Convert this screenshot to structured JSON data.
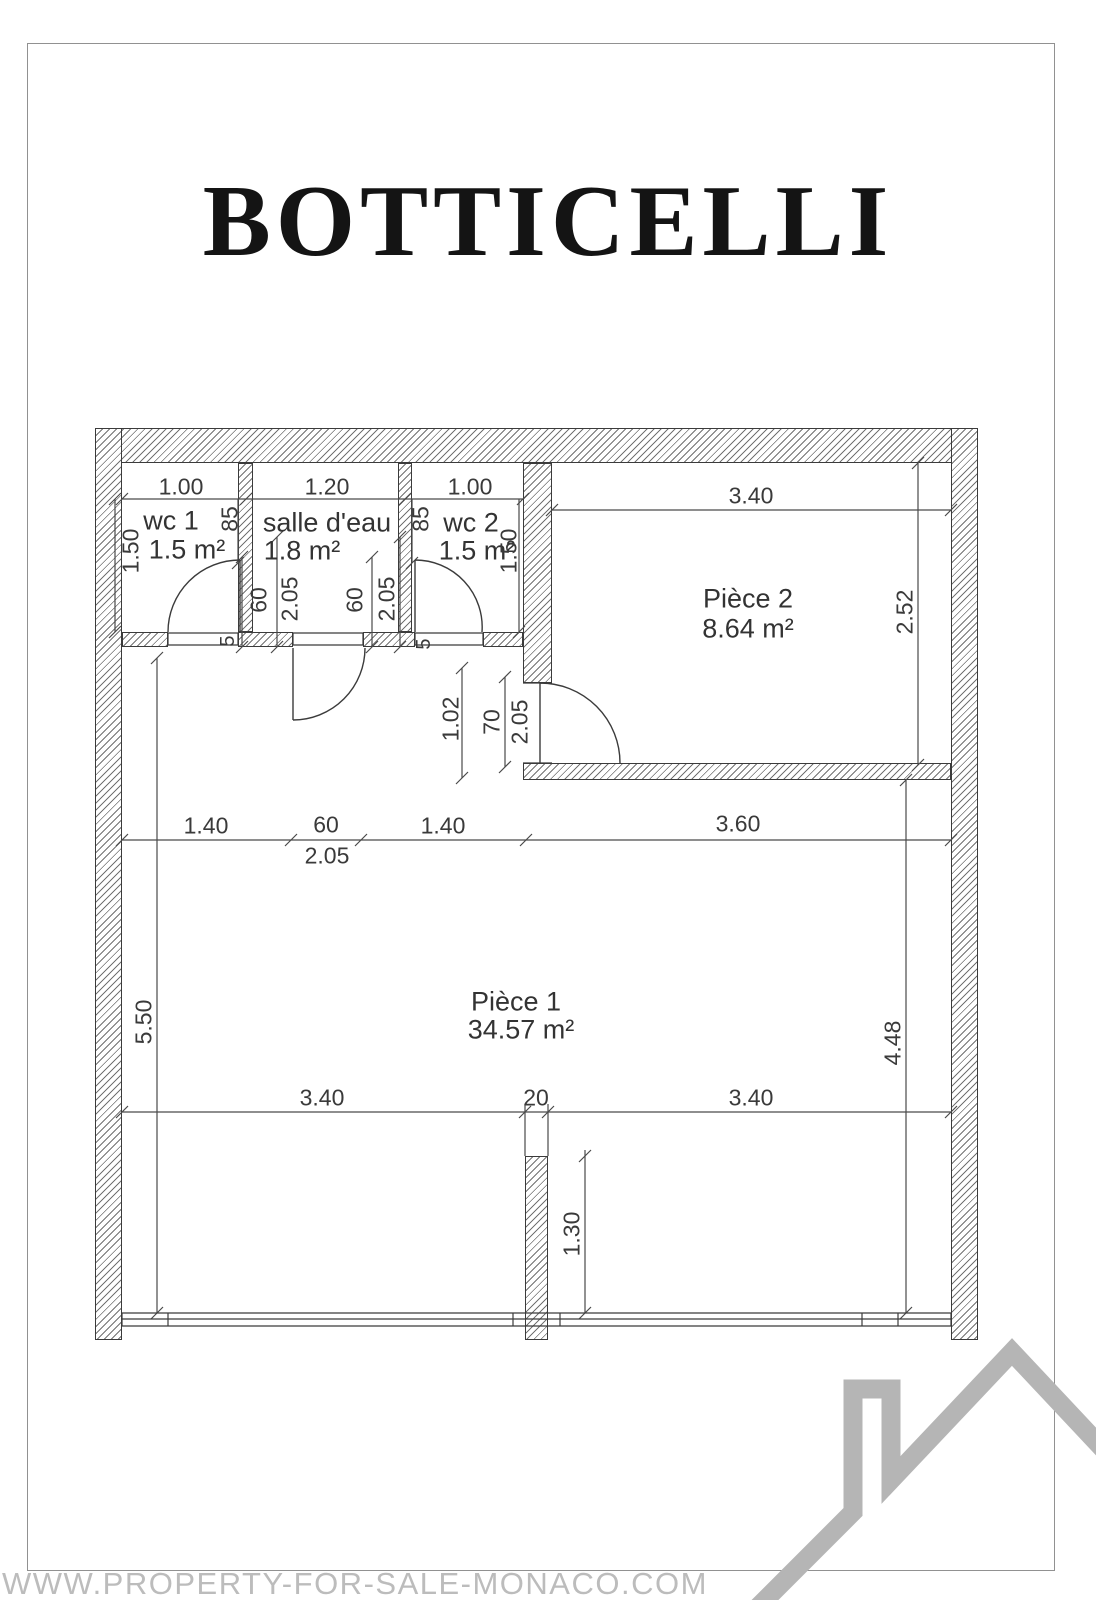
{
  "title": "BOTTICELLI",
  "watermark": "WWW.PROPERTY-FOR-SALE-MONACO.COM",
  "rooms": {
    "wc1": {
      "name": "wc 1",
      "area": "1.5 m²"
    },
    "salle": {
      "name": "salle d'eau",
      "area": "1.8 m²"
    },
    "wc2": {
      "name": "wc 2",
      "area": "1.5 m²"
    },
    "piece2": {
      "name": "Pièce 2",
      "area": "8.64 m²"
    },
    "piece1": {
      "name": "Pièce 1",
      "area": "34.57 m²"
    }
  },
  "dims": {
    "wc1_width": "1.00",
    "salle_width": "1.20",
    "wc2_width": "1.00",
    "wc1_height": "1.50",
    "wc2_height": "1.50",
    "wc1_door": "85",
    "wc2_door": "85",
    "salle_door1_w": "60",
    "salle_door1_h": "2.05",
    "salle_door2_w": "60",
    "salle_door2_h": "2.05",
    "wc1_stop": "5",
    "wc2_stop": "5",
    "piece2_width": "3.40",
    "piece2_height": "2.52",
    "hall_width": "1.02",
    "piece2_door_w": "70",
    "piece2_door_h": "2.05",
    "row_seg1": "1.40",
    "row_seg2": "60",
    "row_seg3": "1.40",
    "row_seg4": "3.60",
    "row_door_h": "2.05",
    "left_height": "5.50",
    "right_height": "4.48",
    "bottom_seg1": "3.40",
    "bottom_pier": "20",
    "bottom_seg2": "3.40",
    "pier_offset": "1.30"
  },
  "colors": {
    "wall_line": "#3b3b3b",
    "dim_line": "#4a4a4a",
    "logo_gray": "#b5b5b5",
    "watermark_gray": "#bcbcbc",
    "frame_gray": "#919191"
  }
}
